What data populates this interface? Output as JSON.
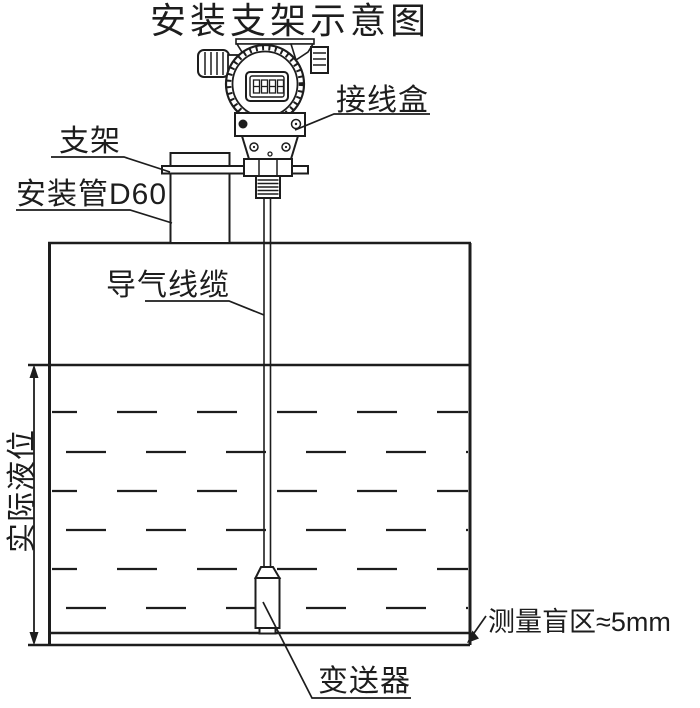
{
  "title": "安装支架示意图",
  "diagram": {
    "labels": {
      "junction_box": "接线盒",
      "bracket": "支架",
      "mounting_pipe": "安装管D60",
      "air_cable": "导气线缆",
      "actual_level": "实际液位",
      "blind_zone": "测量盲区≈5mm",
      "transmitter": "变送器"
    },
    "lcd_display": "8888",
    "colors": {
      "line": "#1d1d1d",
      "background": "#ffffff"
    }
  }
}
